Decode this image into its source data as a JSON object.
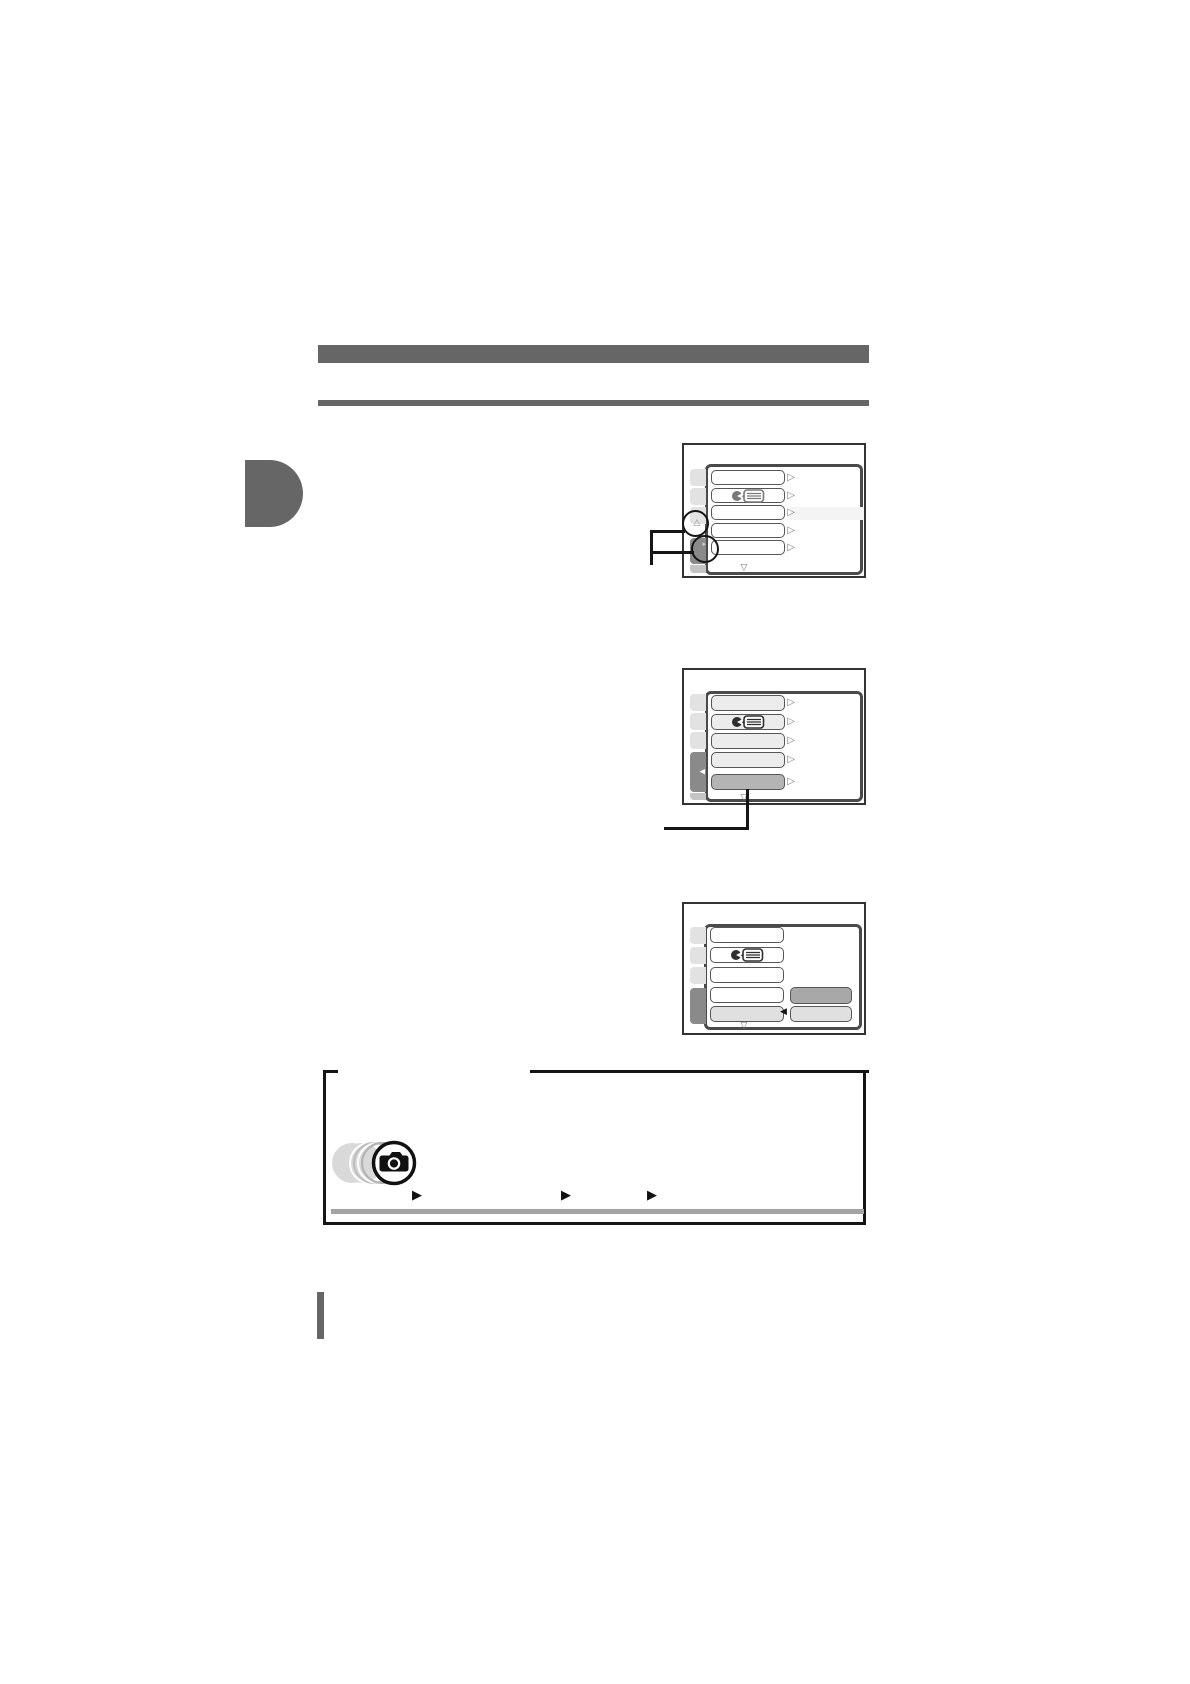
{
  "header": {
    "section_bar_color": "#666666",
    "divider_rule_color": "#666666"
  },
  "chapter_tab": {
    "color": "#666666"
  },
  "glyphs": {
    "row_arrow": "▷",
    "scroll_down": "▽",
    "scroll_up": "△",
    "tab_pointer_small": "▸",
    "tab_pointer_left_white": "◀",
    "submenu_pointer_left": "◀",
    "note_bullet": "▶"
  },
  "screens": [
    {
      "id": "step-1",
      "sidebar_tabs": 4,
      "selected_tab": 4,
      "menu_rows": 5,
      "icon_on_row": 2,
      "highlighted_row": null,
      "annotations": [
        "scroll-up-indicator-circled",
        "selected-tab-pointer-circled",
        "callout-bracket-left"
      ]
    },
    {
      "id": "step-2",
      "sidebar_tabs": 4,
      "selected_tab": 4,
      "menu_rows": 5,
      "icon_on_row": 2,
      "highlighted_row": 5,
      "annotations": [
        "callout-line-from-highlighted-row"
      ]
    },
    {
      "id": "step-3",
      "sidebar_tabs": 4,
      "selected_tab": 4,
      "menu_rows": 5,
      "icon_on_row": 2,
      "highlighted_row": 5,
      "submenu": {
        "items": 2,
        "highlighted_item": 1
      }
    }
  ],
  "icons": {
    "menu_row_icon": "speaking-person-with-list-bubble",
    "note_box_icon": "camera-with-motion-rings"
  },
  "note_box": {
    "bullets": 3,
    "bottom_rule_color": "#a3a3a3"
  },
  "colors": {
    "screen_bezel_border": "#333333",
    "menu_panel_border": "#4a4a4a",
    "sidebar_tab_light": "#e2e2e2",
    "sidebar_tab_selected": "#8a8a8a",
    "menu_row_border": "#565656",
    "menu_row_fill_step1": "#ffffff",
    "menu_row_fill_step2": "#ececec",
    "menu_row_highlight": "#b4b4b4",
    "submenu_top_fill": "#a8a8a8",
    "submenu_bottom_fill": "#e0e0e0",
    "annotation_line": "#151515"
  }
}
